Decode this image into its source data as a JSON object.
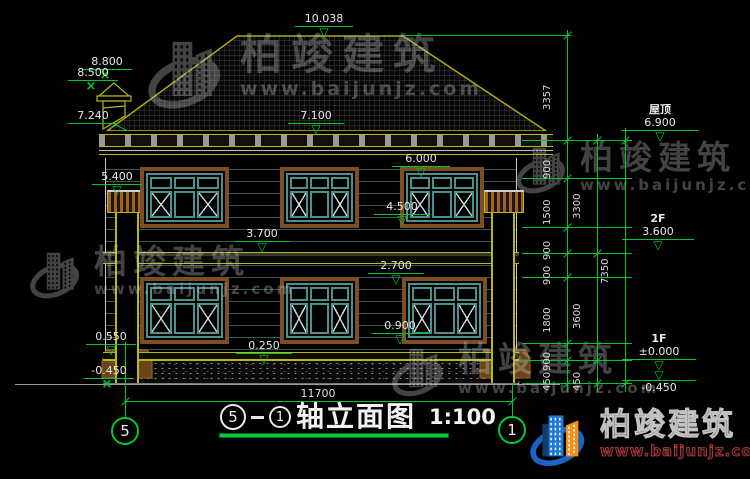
{
  "title_block": {
    "axis_a": "5",
    "axis_b": "1",
    "name": "轴立面图",
    "scale": "1:100"
  },
  "axis_bubbles": {
    "left": "5",
    "right": "1"
  },
  "bottom_dimension": "11700",
  "levels_center": [
    "10.038",
    "7.100",
    "6.000",
    "4.500",
    "3.700",
    "2.700",
    "0.900",
    "0.250"
  ],
  "levels_left": [
    "8.800",
    "8.500",
    "7.240",
    "5.400",
    "0.550",
    "-0.450"
  ],
  "levels_right": [
    {
      "label": "屋顶",
      "value": "6.900"
    },
    {
      "label": "2F",
      "value": "3.600"
    },
    {
      "label": "1F",
      "value": "±0.000"
    },
    {
      "label": "",
      "value": "-0.450"
    }
  ],
  "dim_chain_inner": [
    "3357",
    "900",
    "1500",
    "900",
    "900",
    "1800",
    "900",
    "450"
  ],
  "dim_chain_middle": [
    "3300",
    "3600",
    "450"
  ],
  "dim_chain_outer": [
    "7350"
  ],
  "watermark": {
    "brand": "柏竣建筑",
    "site": "www.baijunjz.com"
  },
  "icons": {
    "level_triangle": "▽",
    "cross": "×"
  },
  "colors": {
    "dim_green": "#00c832",
    "roof_outline": "#a8a818",
    "frame_brown": "#7d4e21",
    "frame_teal": "#4e8f8f",
    "wall_line": "#35585a",
    "logo_blue": "#1b63c4",
    "logo_orange": "#f29018"
  }
}
